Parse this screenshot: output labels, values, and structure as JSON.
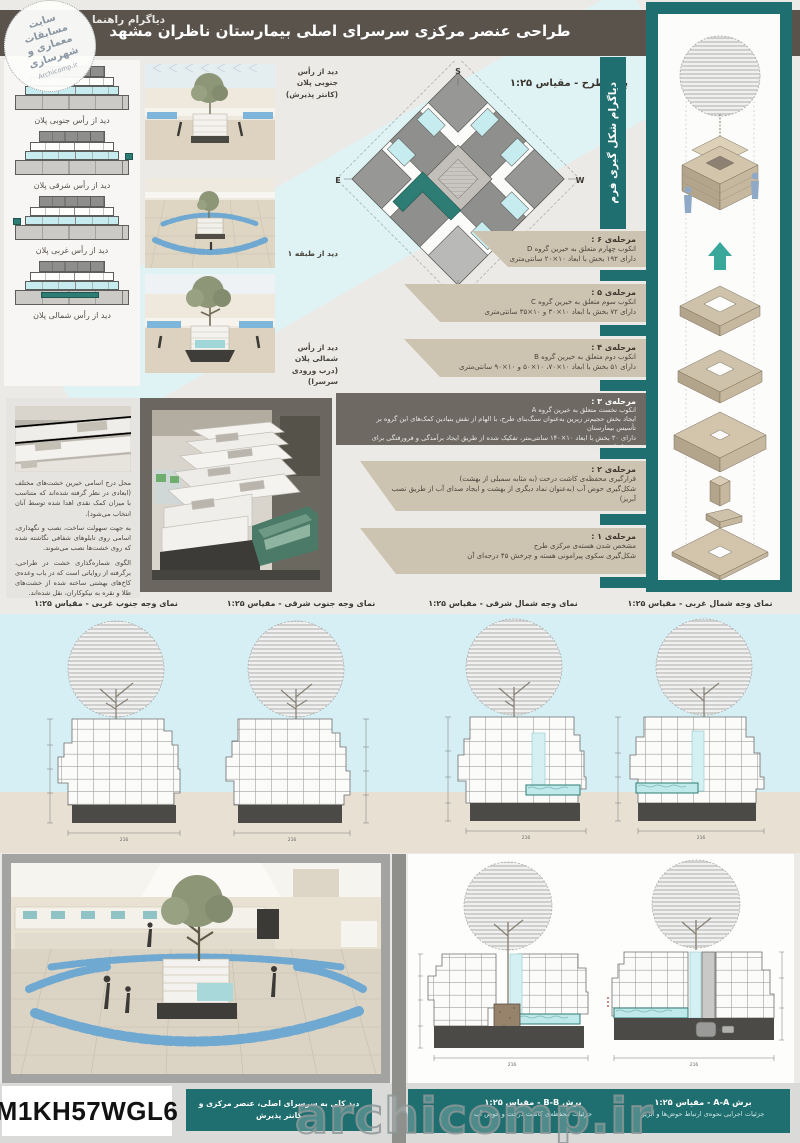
{
  "header": {
    "title": "طراحی عنصر مرکزی سرسرای اصلی بیمارستان ناظران مشهد",
    "guide_label": "دیاگرام راهنما"
  },
  "stamp": {
    "line1": "سایت",
    "line2": "مسابقات",
    "line3": "معماری و",
    "line4": "شهرسازی",
    "site": "Archicomp.ir"
  },
  "left_diagrams": {
    "items": [
      {
        "label": "دید از رأس جنوبی پلان"
      },
      {
        "label": "دید از رأس شرقی پلان"
      },
      {
        "label": "دید از رأس غربی پلان"
      },
      {
        "label": "دید از رأس شمالی پلان"
      }
    ]
  },
  "renders": {
    "r1_line1": "دید از رأس جنوبی پلان",
    "r1_line2": "(کانتر پذیرش)",
    "r2_line1": "دید از طبقه ۱",
    "r3_line1": "دید از رأس شمالی پلان",
    "r3_line2": "(درب ورودی سرسرا)"
  },
  "plan": {
    "label": "پلان طرح - مقیاس ۱:۲۵",
    "compass_s": "S",
    "compass_e": "E",
    "compass_w": "W",
    "compass_n": "N"
  },
  "form_diagram": {
    "label": "دیاگرام شکل گیری فرم"
  },
  "stages": {
    "s6": {
      "title": "مرحله‌ی ۶ :",
      "line1": "انکوب چهارم متعلق به خیرین گروه D",
      "line2": "دارای ۱۹۲ بخش با ابعاد ۱۰×۲۰ سانتی‌متری"
    },
    "s5": {
      "title": "مرحله‌ی ۵ :",
      "line1": "انکوب سوم متعلق به خیرین گروه C",
      "line2": "دارای ۷۲ بخش با ابعاد ۱۰×۳۰ و ۱۰×۳۵ سانتی‌متری"
    },
    "s4": {
      "title": "مرحله‌ی ۴ :",
      "line1": "انکوب دوم متعلق به خیرین گروه B",
      "line2": "دارای ۵۱ بخش با ابعاد ۱۰×۷۰، ۱۰×۵۰ و ۱۰×۹۰ سانتی‌متری"
    },
    "s3": {
      "title": "مرحله‌ی ۳ :",
      "line1": "انکوب نخست متعلق به خیرین گروه A",
      "line2": "ایجاد بخش حجیم‌تر زیرین به‌عنوان سنگ‌بنای طرح، با الهام از نقش بنیادین کمک‌های این گروه بر تأسیس بیمارستان",
      "line3": "دارای ۳۰ بخش با ابعاد ۱۰×۱۴۰ سانتی‌متر، تفکیک شده از طریق ایجاد برآمدگی و فرورفتگی برای درج اسامی خیرین"
    },
    "s2": {
      "title": "مرحله‌ی ۲ :",
      "line1": "قرارگیری محفظه‌ی کاشت درخت (به مثابه سمبلی از بهشت)",
      "line2": "شکل‌گیری حوض آب (به‌عنوان نماد دیگری از بهشت و ایجاد صدای آب از طریق نصب آبریز)"
    },
    "s1": {
      "title": "مرحله‌ی ۱ :",
      "line1": "مشخص شدن هسته‌ی مرکزی طرح",
      "line2": "شکل‌گیری سکوی پیرامونی هسته و چرخش ۴۵ درجه‌ای آن"
    }
  },
  "notes": {
    "p1": "محل درج اسامی خیرین خشت‌های مختلف (ابعادی در نظر گرفته شده‌اند که متناسب با میزان کمک نقدی اهدا شده توسط آنان انتخاب می‌شود).",
    "p2": "به جهت سهولت ساخت، نصب و نگهداری، اسامی روی تابلوهای شفافی نگاشته شده که روی خشت‌ها نصب می‌شوند.",
    "p3": "الگوی شماره‌گذاری خشت در طراحی، برگرفته از روایاتی است که در باب وعده‌ی کاخ‌های بهشتی ساخته شده از خشت‌های طلا و نقره به نیکوکاران، نقل شده‌اند."
  },
  "elevations": {
    "e1": "نمای وجه جنوب غربی - مقیاس ۱:۲۵",
    "e2": "نمای وجه جنوب شرقی - مقیاس ۱:۲۵",
    "e3": "نمای وجه شمال شرقی - مقیاس ۱:۲۵",
    "e4": "نمای وجه شمال غربی - مقیاس ۱:۲۵"
  },
  "drawings": {
    "dim_total": "216"
  },
  "bottom": {
    "code": "M1KH57WGL6",
    "render_caption": "دید کلی به سرسرای اصلی، عنصر مرکزی و کانتر پذیرش",
    "section_b_title": "برش B-B - مقیاس ۱:۲۵",
    "section_b_sub": "جزئیات محفظه‌ی کاشت درخت و حوض آب",
    "section_a_title": "برش A-A - مقیاس ۱:۲۵",
    "section_a_sub": "جزئیات اجرایی نحوه‌ی ارتباط حوض‌ها و آبریز",
    "watermark": "archicomp.ir"
  },
  "colors": {
    "teal": "#1f6f70",
    "accent_teal": "#2e7d74",
    "header_gray": "#59534c",
    "stage_beige": "#cdc3b1",
    "stage_dark": "#6e6a63",
    "sky": "#d5eff4",
    "ground": "#e8e1d3",
    "water": "#bfe9ea",
    "chair_blue": "#6fa8d0"
  }
}
